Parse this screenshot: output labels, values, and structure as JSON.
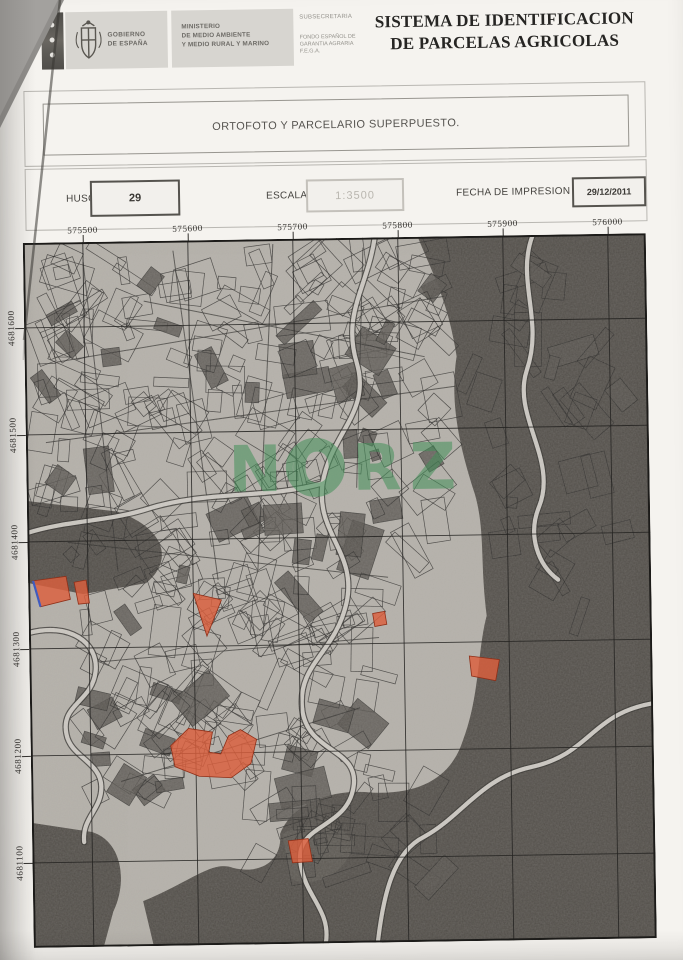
{
  "header": {
    "logo": {
      "government_line1": "GOBIERNO",
      "government_line2": "DE ESPAÑA",
      "ministry_line1": "MINISTERIO",
      "ministry_line2": "DE MEDIO AMBIENTE",
      "ministry_line3": "Y MEDIO RURAL Y MARINO",
      "department_line1": "SUBSECRETARIA",
      "department_line2": "FONDO ESPAÑOL DE",
      "department_line3": "GARANTIA AGRARIA",
      "department_line4": "F.E.G.A."
    },
    "title_line1": "SISTEMA DE IDENTIFICACION",
    "title_line2": "DE PARCELAS AGRICOLAS"
  },
  "subtitle": "ORTOFOTO Y PARCELARIO SUPERPUESTO.",
  "fields": {
    "huso_label": "HUSO",
    "huso_value": "29",
    "escala_label": "ESCALA",
    "escala_value": "1:3500",
    "fecha_label": "FECHA DE IMPRESION",
    "fecha_value": "29/12/2011"
  },
  "map": {
    "x_ticks": [
      "575500",
      "575600",
      "575700",
      "575800",
      "575900",
      "576000"
    ],
    "y_ticks": [
      "4681600",
      "4681500",
      "4681400",
      "4681300",
      "4681200",
      "4681100"
    ],
    "watermark": "NORZ",
    "watermark_color": "#44915a",
    "highlight_color": "#dc5f3d",
    "highlight_outline_color": "#8f2f18",
    "selected_outline_color": "#3f5bbf",
    "highlights": [
      {
        "name": "left-edge-parcel",
        "points": [
          [
            5,
            338
          ],
          [
            38,
            334
          ],
          [
            42,
            357
          ],
          [
            12,
            364
          ]
        ],
        "edge": [
          [
            5,
            338
          ],
          [
            12,
            364
          ]
        ]
      },
      {
        "name": "left-strip-parcel",
        "points": [
          [
            46,
            340
          ],
          [
            58,
            338
          ],
          [
            61,
            361
          ],
          [
            50,
            362
          ]
        ]
      },
      {
        "name": "fan-parcel",
        "points": [
          [
            165,
            353
          ],
          [
            193,
            360
          ],
          [
            178,
            396
          ]
        ]
      },
      {
        "name": "small-dot-parcel",
        "points": [
          [
            344,
            376
          ],
          [
            356,
            374
          ],
          [
            358,
            387
          ],
          [
            346,
            389
          ]
        ]
      },
      {
        "name": "cluster-parcel",
        "points": [
          [
            440,
            420
          ],
          [
            470,
            424
          ],
          [
            466,
            445
          ],
          [
            442,
            440
          ]
        ]
      },
      {
        "name": "large-parcel",
        "points": [
          [
            140,
            505
          ],
          [
            158,
            488
          ],
          [
            182,
            492
          ],
          [
            178,
            512
          ],
          [
            190,
            514
          ],
          [
            198,
            496
          ],
          [
            210,
            490
          ],
          [
            226,
            500
          ],
          [
            220,
            524
          ],
          [
            200,
            538
          ],
          [
            168,
            536
          ],
          [
            144,
            526
          ]
        ]
      },
      {
        "name": "bottom-parcel",
        "points": [
          [
            256,
            602
          ],
          [
            276,
            600
          ],
          [
            280,
            623
          ],
          [
            260,
            624
          ]
        ]
      }
    ]
  }
}
